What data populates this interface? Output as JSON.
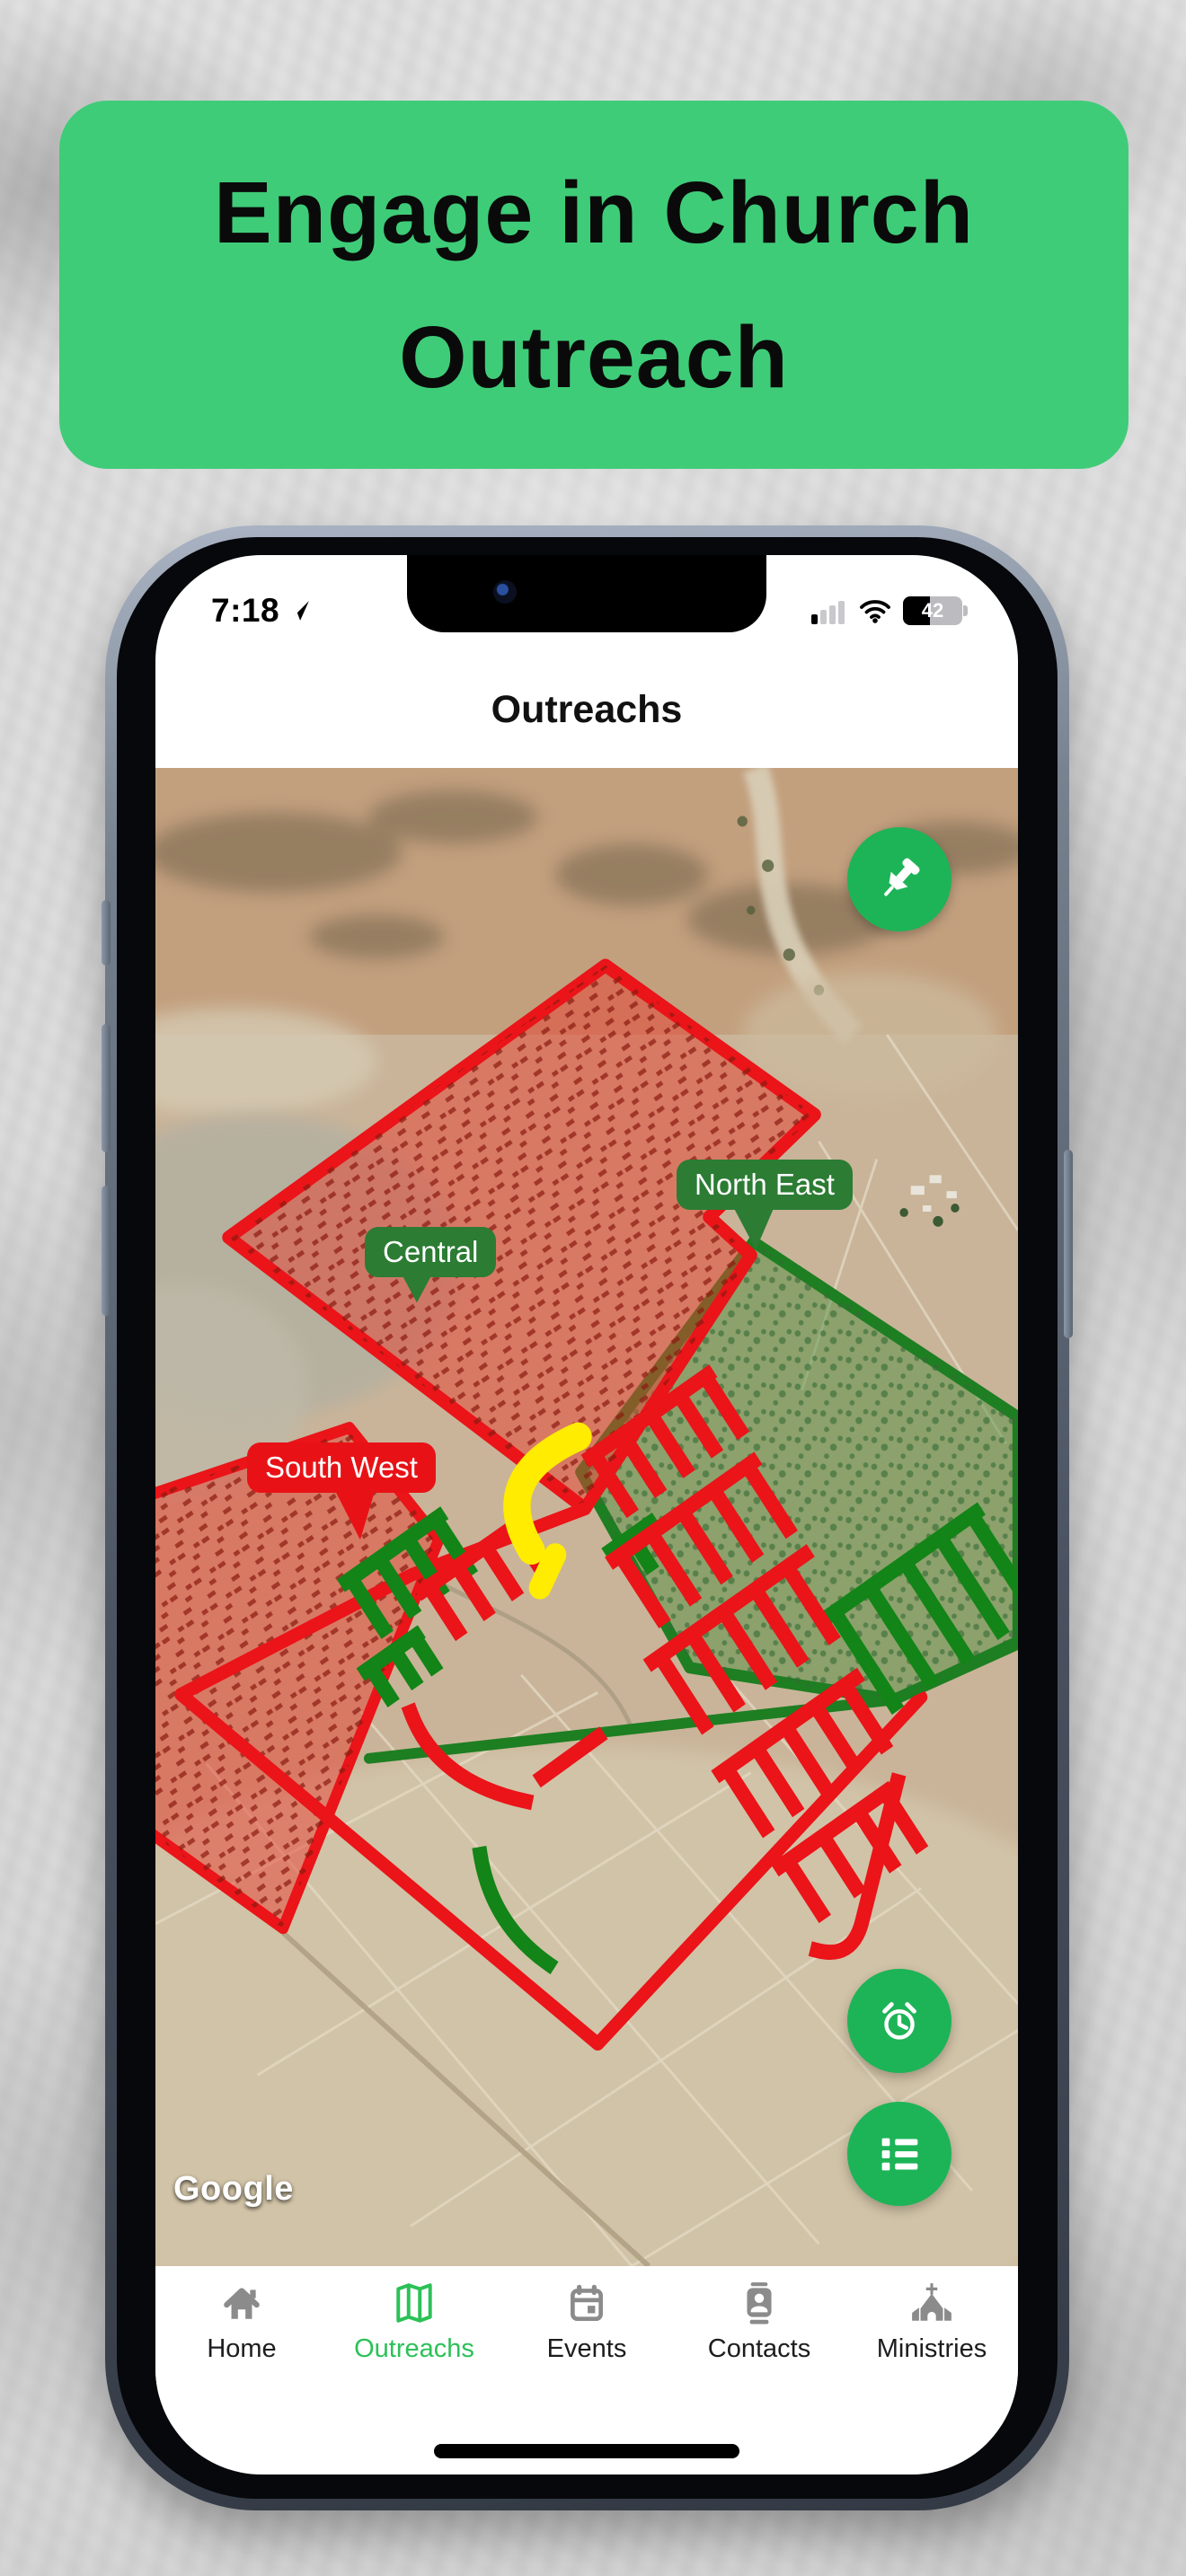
{
  "banner": {
    "line1": "Engage in Church",
    "line2": "Outreach",
    "bg_color": "#3fcc78"
  },
  "status_bar": {
    "time": "7:18",
    "battery_percent": "42"
  },
  "header": {
    "title": "Outreachs"
  },
  "map": {
    "attribution": "Google",
    "labels": {
      "central": "Central",
      "north_east": "North East",
      "south_west": "South West"
    },
    "label_colors": {
      "central": "#2c7c34",
      "north_east": "#2c7c34",
      "south_west": "#e81216"
    },
    "fab_icons": [
      "pushpin-icon",
      "alarm-clock-icon",
      "list-icon"
    ],
    "region_colors": {
      "reached_red": "#ea1419",
      "unreached_green": "#1e7e22",
      "highlight_yellow": "#ffec00"
    }
  },
  "tab_bar": {
    "items": [
      {
        "label": "Home",
        "icon": "home-icon",
        "active": false
      },
      {
        "label": "Outreachs",
        "icon": "map-icon",
        "active": true
      },
      {
        "label": "Events",
        "icon": "calendar-icon",
        "active": false
      },
      {
        "label": "Contacts",
        "icon": "contacts-icon",
        "active": false
      },
      {
        "label": "Ministries",
        "icon": "church-icon",
        "active": false
      }
    ],
    "active_color": "#2bc157",
    "inactive_color": "#8b8b8b"
  },
  "colors": {
    "banner_green": "#3fcc78",
    "fab_green": "#1db457"
  }
}
